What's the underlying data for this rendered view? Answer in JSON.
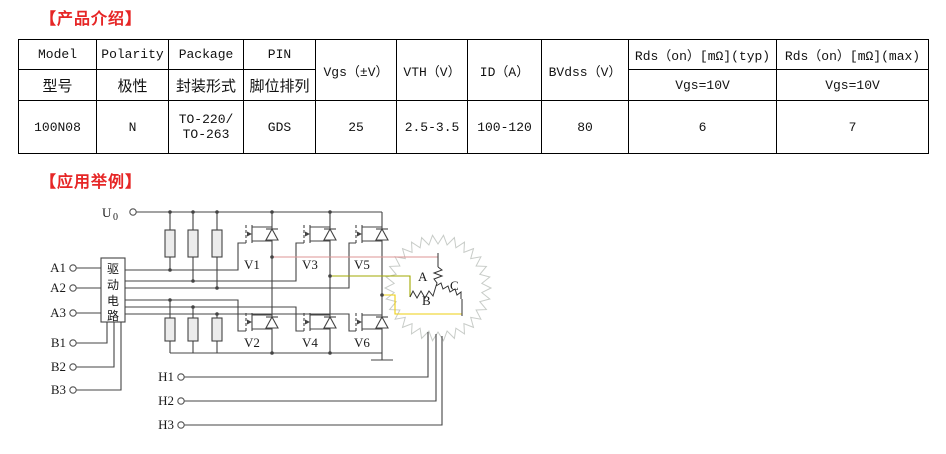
{
  "sections": {
    "intro_title": "【产品介绍】",
    "example_title": "【应用举例】",
    "title_color": "#e62626"
  },
  "spec_table": {
    "header_en": [
      "Model",
      "Polarity",
      "Package",
      "PIN",
      "Vgs（±V）",
      "VTH（V）",
      "ID（A）",
      "BVdss（V）",
      "Rds（on）[mΩ](typ)",
      "Rds（on）[mΩ](max)"
    ],
    "header_cn": [
      "型号",
      "极性",
      "封装形式",
      "脚位排列"
    ],
    "subheader_rds": [
      "Vgs=10V",
      "Vgs=10V"
    ],
    "data_row": {
      "model": "100N08",
      "polarity": "N",
      "package_line1": "TO-220/",
      "package_line2": "TO-263",
      "pin": "GDS",
      "vgs": "25",
      "vth": "2.5-3.5",
      "id": "100-120",
      "bvdss": "80",
      "rds_typ": "6",
      "rds_max": "7"
    }
  },
  "circuit": {
    "supply": {
      "base": "U",
      "sub": "0"
    },
    "driver_chars": [
      "驱",
      "动",
      "电",
      "路"
    ],
    "inputs_a": [
      "A1",
      "A2",
      "A3"
    ],
    "inputs_b": [
      "B1",
      "B2",
      "B3"
    ],
    "hall_inputs": [
      "H1",
      "H2",
      "H3"
    ],
    "fets_top": [
      "V1",
      "V3",
      "V5"
    ],
    "fets_bottom": [
      "V2",
      "V4",
      "V6"
    ],
    "motor_phases": [
      "A",
      "B",
      "C"
    ],
    "wire_colors": {
      "phase_a": "#dd9494",
      "phase_b": "#a2aa00",
      "phase_c": "#eecf10",
      "line": "#444444",
      "stator": "#c8ccc8"
    }
  }
}
